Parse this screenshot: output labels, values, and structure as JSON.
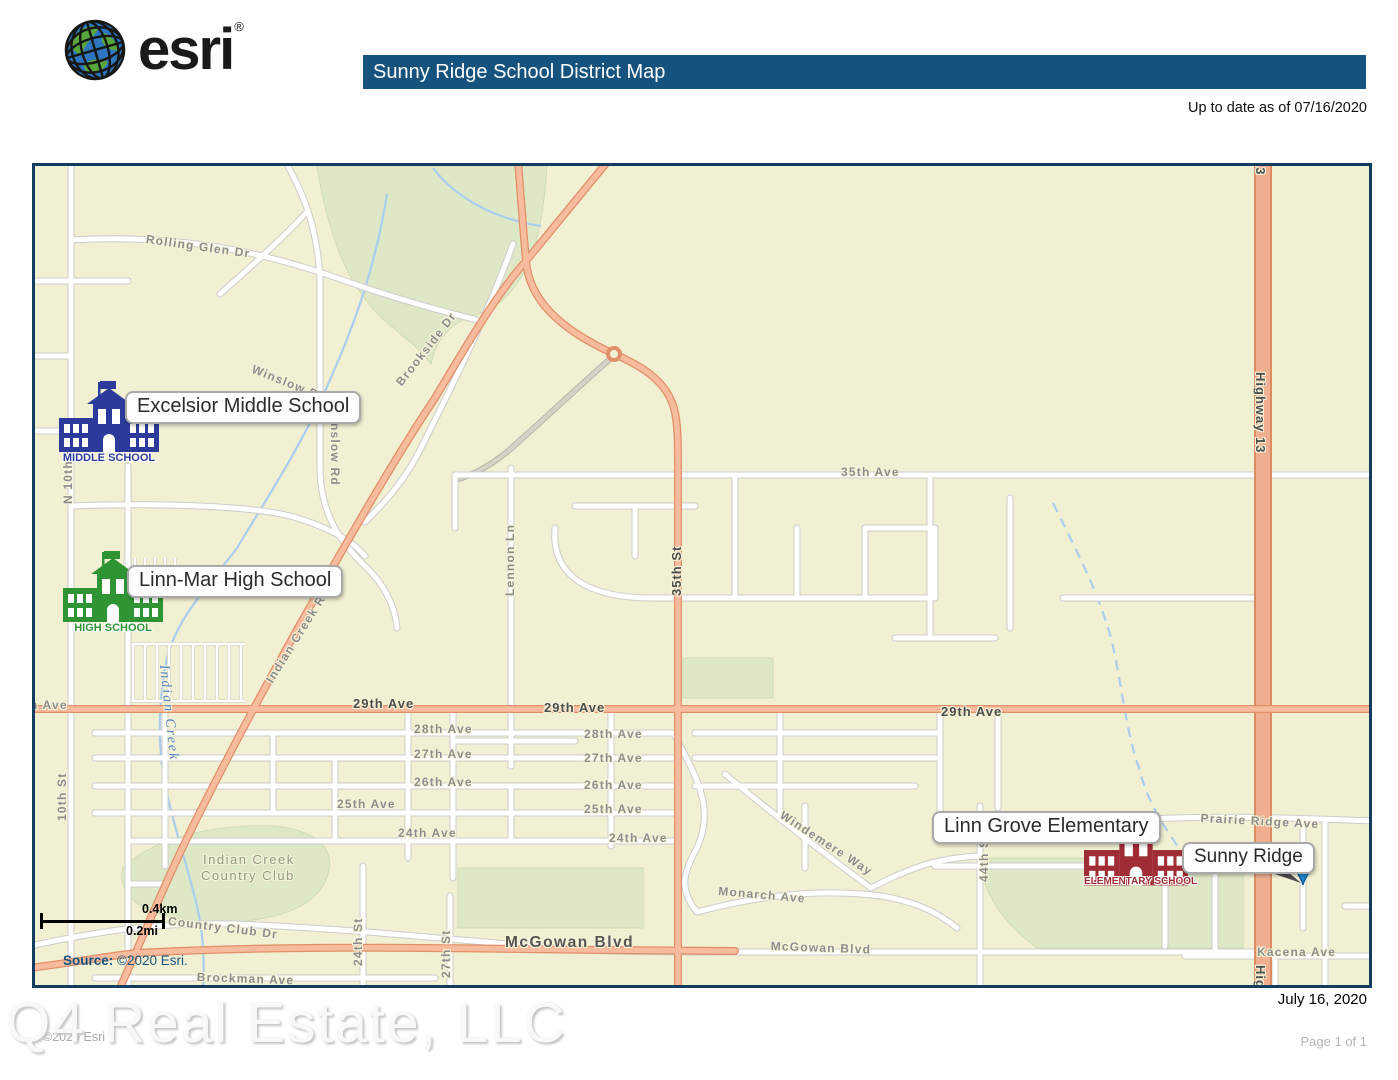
{
  "header": {
    "logo_text": "esri",
    "logo_registered": "®",
    "title": "Sunny Ridge School District Map",
    "updated_note": "Up to date as of 07/16/2020"
  },
  "map": {
    "schools": [
      {
        "name": "Excelsior Middle School",
        "type_label": "MIDDLE SCHOOL",
        "color": "#2b3a9b"
      },
      {
        "name": "Linn-Mar High School",
        "type_label": "HIGH SCHOOL",
        "color": "#2f9434"
      },
      {
        "name": "Linn Grove Elementary",
        "type_label": "ELEMENTARY SCHOOL",
        "color": "#a02c35"
      }
    ],
    "poi": {
      "name": "Sunny Ridge",
      "pin_color": "#1e88d2"
    },
    "scale_bar": {
      "km": "0.4km",
      "mi": "0.2mi"
    },
    "source": {
      "label": "Source:",
      "value": " ©2020 Esri."
    },
    "street_labels": [
      {
        "text": "29th Ave",
        "x": -26,
        "y": 532,
        "rot": 0,
        "cls": "st"
      },
      {
        "text": "Rolling Glen Dr",
        "x": 112,
        "y": 66,
        "rot": 8,
        "cls": "st"
      },
      {
        "text": "Winslow Rd",
        "x": 220,
        "y": 196,
        "rot": 22,
        "cls": "st"
      },
      {
        "text": "Winslow Rd",
        "x": 307,
        "y": 240,
        "rot": 90,
        "cls": "st"
      },
      {
        "text": "Brookside Dr",
        "x": 358,
        "y": 214,
        "rot": -52,
        "cls": "st"
      },
      {
        "text": "Lennon Ln",
        "x": 468,
        "y": 430,
        "rot": -90,
        "cls": "st"
      },
      {
        "text": "35th St",
        "x": 634,
        "y": 430,
        "rot": -90,
        "cls": "stb"
      },
      {
        "text": "35th Ave",
        "x": 806,
        "y": 299,
        "rot": 0,
        "cls": "st"
      },
      {
        "text": "Highway 13",
        "x": 1233,
        "y": -72,
        "rot": 90,
        "cls": "stb"
      },
      {
        "text": "Highway 13",
        "x": 1233,
        "y": 206,
        "rot": 90,
        "cls": "stb"
      },
      {
        "text": "Highway 13",
        "x": 1233,
        "y": 799,
        "rot": 90,
        "cls": "stb"
      },
      {
        "text": "Indian Creek Rd",
        "x": 228,
        "y": 512,
        "rot": -58,
        "cls": "st"
      },
      {
        "text": "Indian Creek",
        "x": 136,
        "y": 498,
        "rot": 84,
        "cls": "creek"
      },
      {
        "text": "N 10th St",
        "x": 26,
        "y": 338,
        "rot": -90,
        "cls": "st"
      },
      {
        "text": "10th St",
        "x": 20,
        "y": 655,
        "rot": -90,
        "cls": "st"
      },
      {
        "text": "29th Ave",
        "x": 318,
        "y": 530,
        "rot": 0,
        "cls": "stb"
      },
      {
        "text": "29th Ave",
        "x": 509,
        "y": 534,
        "rot": 0,
        "cls": "stb"
      },
      {
        "text": "29th Ave",
        "x": 906,
        "y": 538,
        "rot": 0,
        "cls": "stb"
      },
      {
        "text": "28th Ave",
        "x": 379,
        "y": 556,
        "rot": 0,
        "cls": "st"
      },
      {
        "text": "28th Ave",
        "x": 549,
        "y": 561,
        "rot": 0,
        "cls": "st"
      },
      {
        "text": "27th Ave",
        "x": 379,
        "y": 581,
        "rot": 0,
        "cls": "st"
      },
      {
        "text": "27th Ave",
        "x": 549,
        "y": 585,
        "rot": 0,
        "cls": "st"
      },
      {
        "text": "26th Ave",
        "x": 379,
        "y": 609,
        "rot": 0,
        "cls": "st"
      },
      {
        "text": "26th Ave",
        "x": 549,
        "y": 612,
        "rot": 0,
        "cls": "st"
      },
      {
        "text": "25th Ave",
        "x": 302,
        "y": 631,
        "rot": 0,
        "cls": "st"
      },
      {
        "text": "25th Ave",
        "x": 549,
        "y": 636,
        "rot": 0,
        "cls": "st"
      },
      {
        "text": "24th Ave",
        "x": 363,
        "y": 660,
        "rot": 0,
        "cls": "st"
      },
      {
        "text": "24th Ave",
        "x": 574,
        "y": 665,
        "rot": 0,
        "cls": "st"
      },
      {
        "text": "Windemere Way",
        "x": 750,
        "y": 642,
        "rot": 33,
        "cls": "st"
      },
      {
        "text": "44th St",
        "x": 942,
        "y": 716,
        "rot": -90,
        "cls": "st"
      },
      {
        "text": "Monarch Ave",
        "x": 684,
        "y": 718,
        "rot": 5,
        "cls": "st"
      },
      {
        "text": "Prairie Ridge Ave",
        "x": 1166,
        "y": 645,
        "rot": 3,
        "cls": "st"
      },
      {
        "text": "McGowan Blvd",
        "x": 470,
        "y": 768,
        "rot": 0,
        "cls": "stb2"
      },
      {
        "text": "McGowan Blvd",
        "x": 736,
        "y": 773,
        "rot": 2,
        "cls": "st"
      },
      {
        "text": "Kacena Ave",
        "x": 1222,
        "y": 779,
        "rot": 0,
        "cls": "st"
      },
      {
        "text": "Country Club Dr",
        "x": 134,
        "y": 748,
        "rot": 7,
        "cls": "st"
      },
      {
        "text": "Brockman Ave",
        "x": 162,
        "y": 804,
        "rot": 2,
        "cls": "st"
      },
      {
        "text": "24th St",
        "x": 316,
        "y": 800,
        "rot": -90,
        "cls": "st"
      },
      {
        "text": "27th St",
        "x": 404,
        "y": 812,
        "rot": -90,
        "cls": "st"
      },
      {
        "text": "Indian Creek",
        "x": 168,
        "y": 686,
        "rot": 0,
        "cls": "area"
      },
      {
        "text": "Country Club",
        "x": 166,
        "y": 702,
        "rot": 0,
        "cls": "area"
      }
    ]
  },
  "footer": {
    "date": "July 16, 2020",
    "watermark": "Q4 Real Estate, LLC",
    "credit": "©2020 Esri",
    "page": "Page 1 of 1"
  },
  "colors": {
    "title_bar": "#15537e",
    "map_border": "#123c60",
    "map_bg": "#f2f0d2",
    "major_road": "#f7bb9e",
    "highway": "#efae8f",
    "green_area": "#dfe8c6",
    "water": "#a9cdee",
    "pin": "#1e88d2"
  }
}
